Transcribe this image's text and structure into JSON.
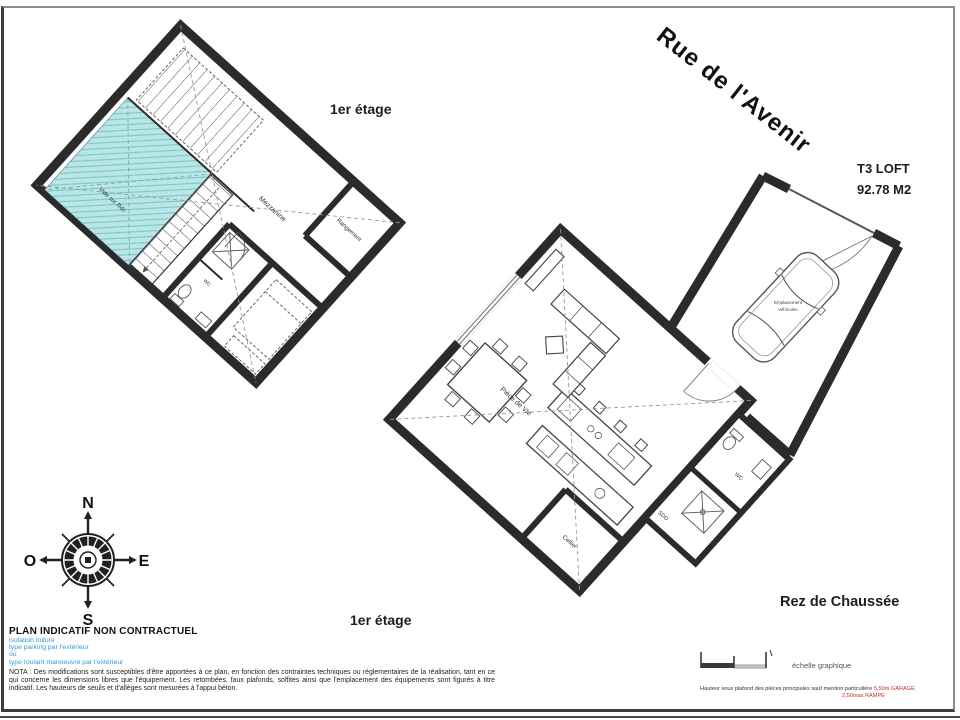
{
  "page": {
    "street_label": "Rue de l'Avenir",
    "unit_type": "T3 LOFT",
    "unit_area": "92.78 M2",
    "first_floor_label_top": "1er étage",
    "first_floor_label_bottom": "1er étage",
    "ground_floor_label": "Rez de Chaussée"
  },
  "compass": {
    "north": "N",
    "east": "E",
    "south": "S",
    "west": "O"
  },
  "first_floor": {
    "rooms": {
      "mezzanine": "Mezzanine",
      "storage": "Rangement",
      "void_label": "Vide sur Rdc",
      "wc": "WC"
    }
  },
  "ground_floor": {
    "rooms": {
      "living": "Pièce de Vie",
      "cellar": "Cellier",
      "wc": "WC",
      "shower": "SDD",
      "vehicle_line1": "Emplacement",
      "vehicle_line2": "véhicules"
    }
  },
  "legal": {
    "title": "PLAN INDICATIF NON CONTRACTUEL",
    "blue_notes": [
      "isolation toiture",
      "type parking par l'extérieur",
      "ou",
      "type roulant manoeuvré par l'extérieur"
    ],
    "nota": "NOTA : Des modifications sont susceptibles d'être apportées à ce plan, en fonction des contraintes techniques ou réglementaires de la réalisation, tant en ce qui concerne les dimensions libres que l'équipement.  Les retombées, faux plafonds, soffites ainsi que l'emplacement des équipements  sont figurés à titre indicatif.   Les hauteurs de seuils et d'allèges sont mesurées à l'appui béton."
  },
  "scale": {
    "label": "échelle graphique"
  },
  "height_note": {
    "black": "Hauteur sous plafond des pièces principales sauf mention particulière",
    "red1": "5,50m GARAGE",
    "red2": "2,50max RAMPE"
  },
  "colors": {
    "wall": "#2b2b2b",
    "void_fill": "#b9e6e6",
    "blue_note": "#2e9bd6",
    "red_note": "#c03030"
  }
}
